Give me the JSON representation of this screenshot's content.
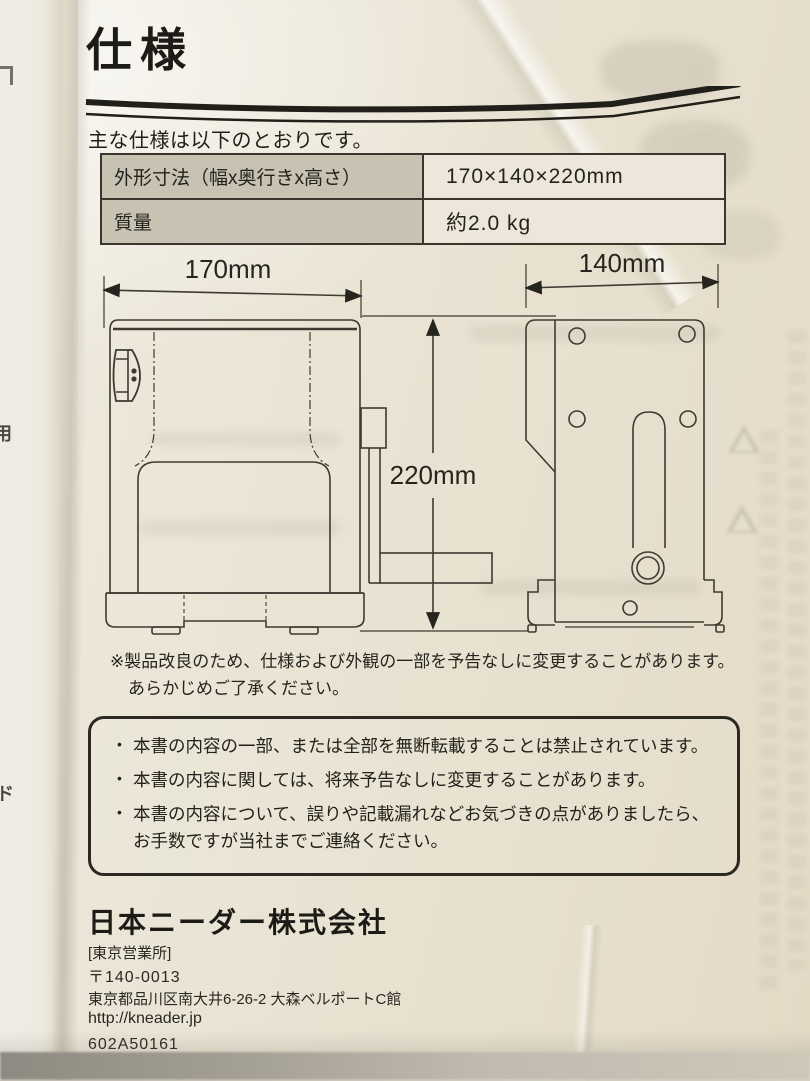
{
  "page": {
    "title": "仕様",
    "intro": "主な仕様は以下のとおりです。"
  },
  "spec_table": {
    "rows": [
      {
        "label": "外形寸法（幅x奥行きx高さ）",
        "value": "170×140×220mm"
      },
      {
        "label": "質量",
        "value": "約2.0 kg"
      }
    ]
  },
  "diagram": {
    "width_label": "170mm",
    "depth_label": "140mm",
    "height_label": "220mm"
  },
  "note": {
    "line1": "※製品改良のため、仕様および外観の一部を予告なしに変更することがあります。",
    "line2": "あらかじめご了承ください。"
  },
  "notice_box": {
    "items": [
      "本書の内容の一部、または全部を無断転載することは禁止されています。",
      "本書の内容に関しては、将来予告なしに変更することがあります。",
      "本書の内容について、誤りや記載漏れなどお気づきの点がありましたら、お手数ですが当社までご連絡ください。"
    ]
  },
  "footer": {
    "company": "日本ニーダー株式会社",
    "office": "[東京営業所]",
    "postal": "〒140-0013",
    "address": "東京都品川区南大井6-26-2 大森ベルポートC館",
    "url": "http://kneader.jp",
    "code": "602A50161"
  },
  "margin_glyphs": {
    "middle": "用",
    "lower": "ド"
  },
  "colors": {
    "paper": "#e9e3d3",
    "ink": "#23211c",
    "table_header_bg": "#c7c2b1",
    "table_value_bg": "#ece7da"
  }
}
